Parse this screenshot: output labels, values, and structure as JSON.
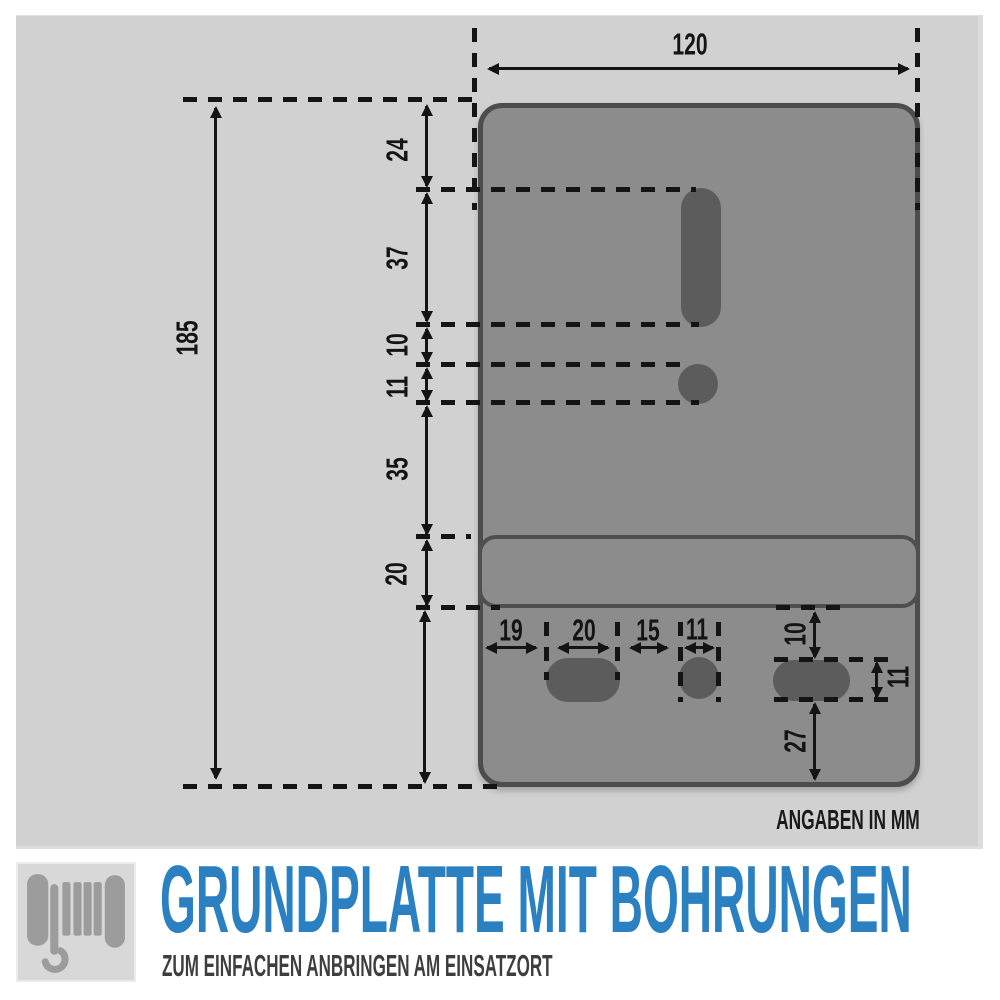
{
  "diagram": {
    "unit_note": "ANGABEN IN MM",
    "overall": {
      "width_mm": "120",
      "height_mm": "185"
    },
    "left_chain": [
      "24",
      "37",
      "10",
      "11",
      "35",
      "20"
    ],
    "bottom_row": [
      "19",
      "20",
      "15",
      "11"
    ],
    "right_chain": [
      "10",
      "11",
      "27"
    ]
  },
  "footer": {
    "title": "GRUNDPLATTE MIT BOHRUNGEN",
    "subtitle": "ZUM EINFACHEN ANBRINGEN AM EINSATZORT",
    "icon": "cable-winch-hook-icon"
  },
  "colors": {
    "accent_blue": "#2b80c2",
    "panel_gray": "#d1d1d1",
    "plate_gray": "#8c8c8c",
    "plate_outline": "#4d4d4d",
    "hole_gray": "#5c5c5c",
    "ink": "#141414"
  }
}
